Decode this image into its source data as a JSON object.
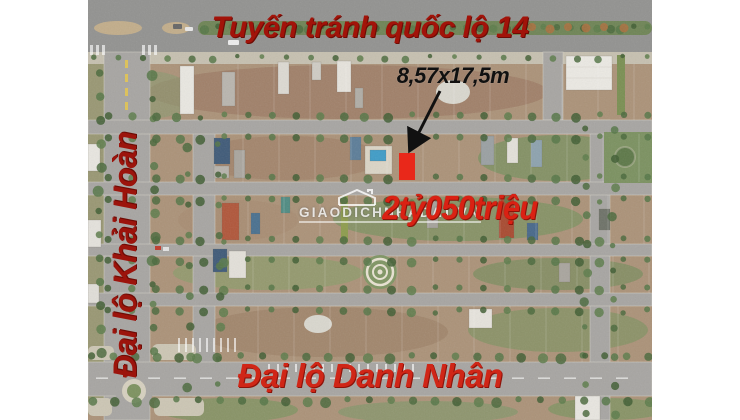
{
  "page": {
    "type": "real-estate aerial listing",
    "canvas_bg": "#ffffff"
  },
  "annotations": {
    "top_road": {
      "label": "Tuyến tránh quốc lộ 14",
      "color": "#a21309"
    },
    "left_road": {
      "label": "Đại lộ Khải Hoàn",
      "color": "#9c140c"
    },
    "bottom_road": {
      "label": "Đại lộ Danh Nhân",
      "color": "#d02617"
    },
    "plot_size": {
      "label": "8,57x17,5m",
      "color": "#101010"
    },
    "price": {
      "label": "2tỷ050triệu",
      "color": "#da2113"
    },
    "watermark": {
      "label": "GIAODICHNHADAT.VN",
      "icon": "house-icon",
      "color": "#ffffff"
    }
  },
  "plot_marker": {
    "color": "#e9281a"
  },
  "photo_palette": {
    "land_tan": "#ab9278",
    "red_dirt": "#9d7d66",
    "grass": "#7b9160",
    "road": "#a7a5a2",
    "highway": "#929290",
    "tree": "#4a683c",
    "pool": "#3f9cc7"
  }
}
